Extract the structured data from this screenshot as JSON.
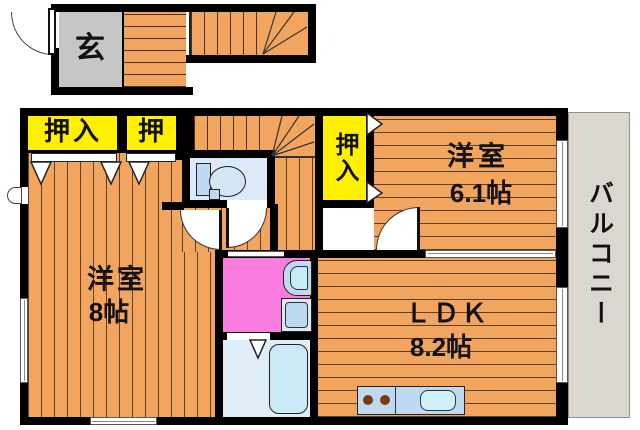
{
  "floorplan": {
    "labels": {
      "entrance": "玄",
      "closet_main": "押入",
      "closet_small": "押",
      "closet_side": "押入",
      "bedroom_a_name": "洋室",
      "bedroom_a_size": "6.1帖",
      "bedroom_b_name": "洋室",
      "bedroom_b_size": "8帖",
      "ldk_name": "ＬＤＫ",
      "ldk_size": "8.2帖",
      "balcony": "バルコニー"
    },
    "colors": {
      "wall": "#000000",
      "floor_orange": "#F2A55E",
      "closet_yellow": "#FFF000",
      "entrance_gray": "#C6C6C6",
      "balcony_gray": "#DBD7D0",
      "washroom_pink": "#F97CDE",
      "fixture_blue": "#BFD9F0",
      "bath_blue": "#DCEAF8"
    },
    "fixtures": [
      "toilet-icon",
      "washbasin-icon",
      "washing-machine-icon",
      "bathtub-icon",
      "kitchen-sink-icon",
      "stove-burner-icon",
      "staircase",
      "door-swing-arc",
      "window",
      "sliding-door"
    ]
  }
}
